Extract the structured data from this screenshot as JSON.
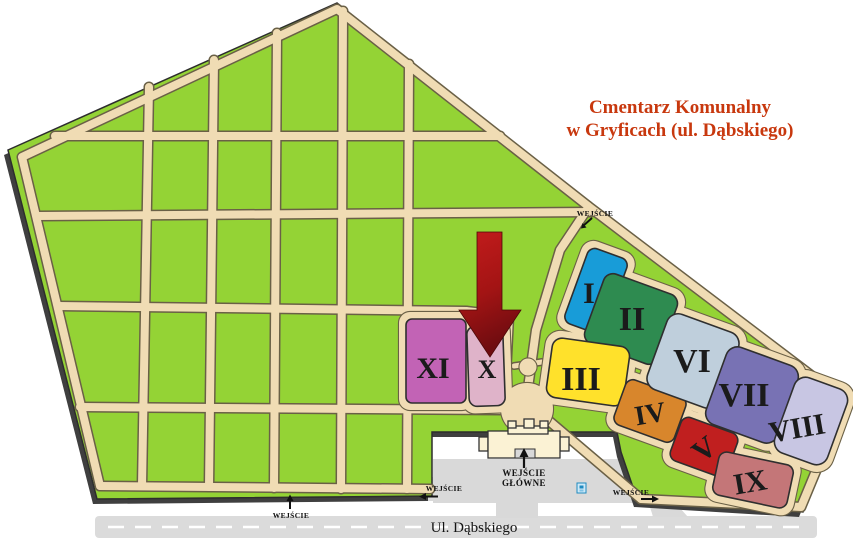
{
  "title": {
    "line1": "Cmentarz Komunalny",
    "line2": "w Gryficach (ul. Dąbskiego)",
    "color": "#C8380E"
  },
  "map": {
    "street_name": "Ul. Dąbskiego",
    "main_entrance": {
      "line1": "WEJŚCIE",
      "line2": "GŁÓWNE"
    },
    "entrances": {
      "north": "WEJŚCIE",
      "south": "WEJŚCIE",
      "west": "WEJŚCIE",
      "east": "WEJŚCIE"
    },
    "sections": [
      {
        "numeral": "I",
        "color": "#189CD8"
      },
      {
        "numeral": "II",
        "color": "#2E8B50"
      },
      {
        "numeral": "III",
        "color": "#FFE12B"
      },
      {
        "numeral": "IV",
        "color": "#D8862C"
      },
      {
        "numeral": "V",
        "color": "#C01F1F"
      },
      {
        "numeral": "VI",
        "color": "#BFCFDC"
      },
      {
        "numeral": "VII",
        "color": "#7872B4"
      },
      {
        "numeral": "VIII",
        "color": "#C8C6E3"
      },
      {
        "numeral": "IX",
        "color": "#C47678"
      },
      {
        "numeral": "X",
        "color": "#DFB3C9"
      },
      {
        "numeral": "XI",
        "color": "#C263B5"
      }
    ],
    "colors": {
      "grounds_green": "#94D335",
      "path_tan": "#F0DCB4",
      "road_gray": "#DBDBDB",
      "pointer_arrow_red": "#A31414",
      "building_cream": "#FBF2D4"
    }
  }
}
